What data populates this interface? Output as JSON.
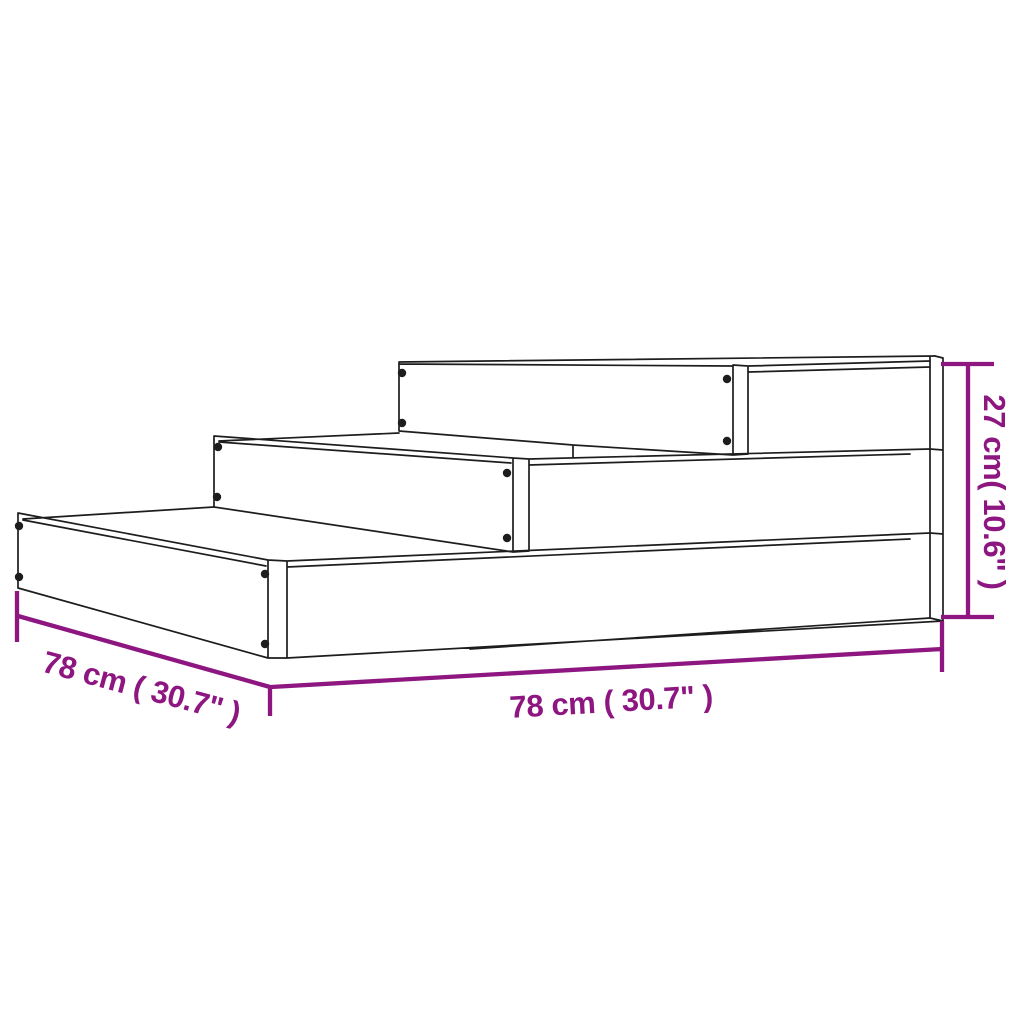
{
  "diagram": {
    "description": "Line drawing of a 3-tier stepped planter with dimension annotations",
    "dimensions": {
      "width": {
        "label": "78 cm ( 30.7\" )",
        "cm": 78,
        "inches": 30.7,
        "position": "bottom"
      },
      "depth": {
        "label": "78 cm ( 30.7\" )",
        "cm": 78,
        "inches": 30.7,
        "position": "lower-left"
      },
      "height": {
        "label": "27 cm( 10.6\" )",
        "cm": 27,
        "inches": 10.6,
        "position": "right"
      }
    },
    "colors": {
      "dimension": "#8D1680",
      "outline": "#1D1D1D",
      "background": "#FFFFFF"
    },
    "screw_count": 12,
    "tier_count": 3
  }
}
